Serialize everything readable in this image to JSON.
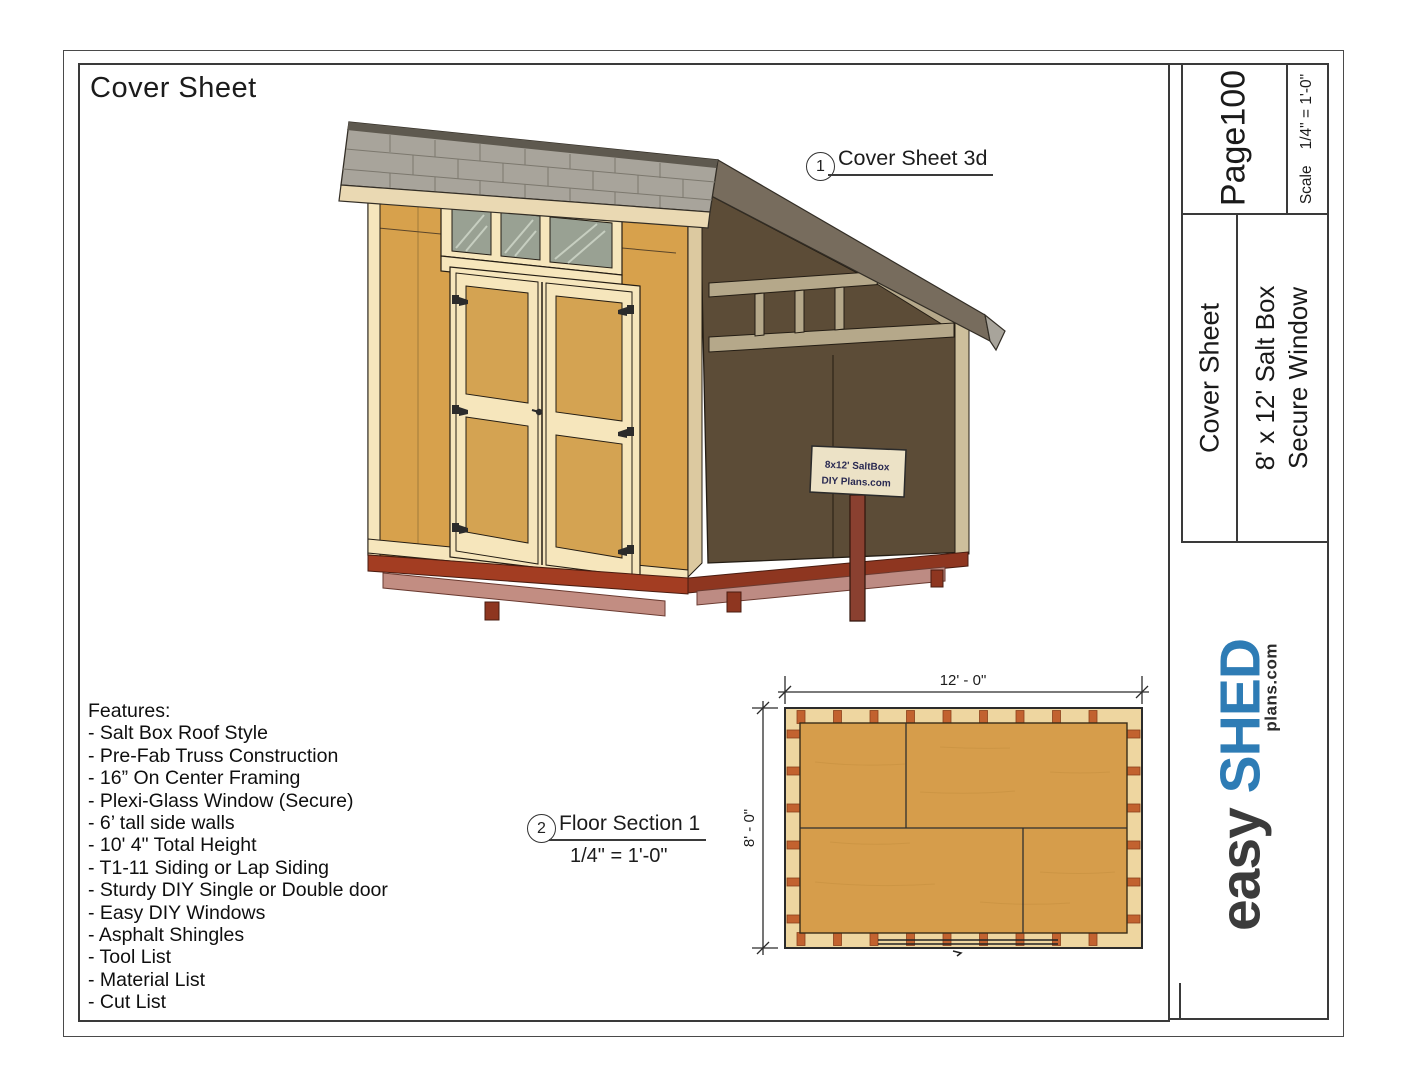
{
  "page": {
    "title": "Cover Sheet"
  },
  "callouts": {
    "c1": {
      "num": "1",
      "label": "Cover Sheet 3d"
    },
    "c2": {
      "num": "2",
      "label": "Floor Section 1",
      "scale": "1/4\" = 1'-0\""
    }
  },
  "features": {
    "heading": "Features:",
    "items": [
      "- Salt Box Roof Style",
      "- Pre-Fab Truss Construction",
      "- 16” On Center Framing",
      "- Plexi-Glass Window (Secure)",
      "- 6’ tall side walls",
      "- 10' 4\" Total Height",
      "- T1-11 Siding or Lap Siding",
      "- Sturdy DIY Single or Double door",
      "- Easy DIY Windows",
      "- Asphalt Shingles",
      "- Tool List",
      "- Material List",
      "- Cut List"
    ]
  },
  "floor_plan": {
    "dim_width": "12' - 0\"",
    "dim_height": "8' - 0\""
  },
  "shed_sign": {
    "line1": "8x12' SaltBox",
    "line2": "DIY Plans.com"
  },
  "title_block": {
    "page_number": "Page100",
    "scale_label": "Scale",
    "scale_value": "1/4\" = 1'-0\"",
    "sheet_name": "Cover Sheet",
    "model_line1": "8' x 12' Salt Box",
    "model_line2": "Secure Window",
    "logo": {
      "word1": "easy",
      "word2": "SHED",
      "suffix": "plans.com",
      "blue": "#2e7cb5",
      "dark": "#3b3b3b"
    }
  }
}
